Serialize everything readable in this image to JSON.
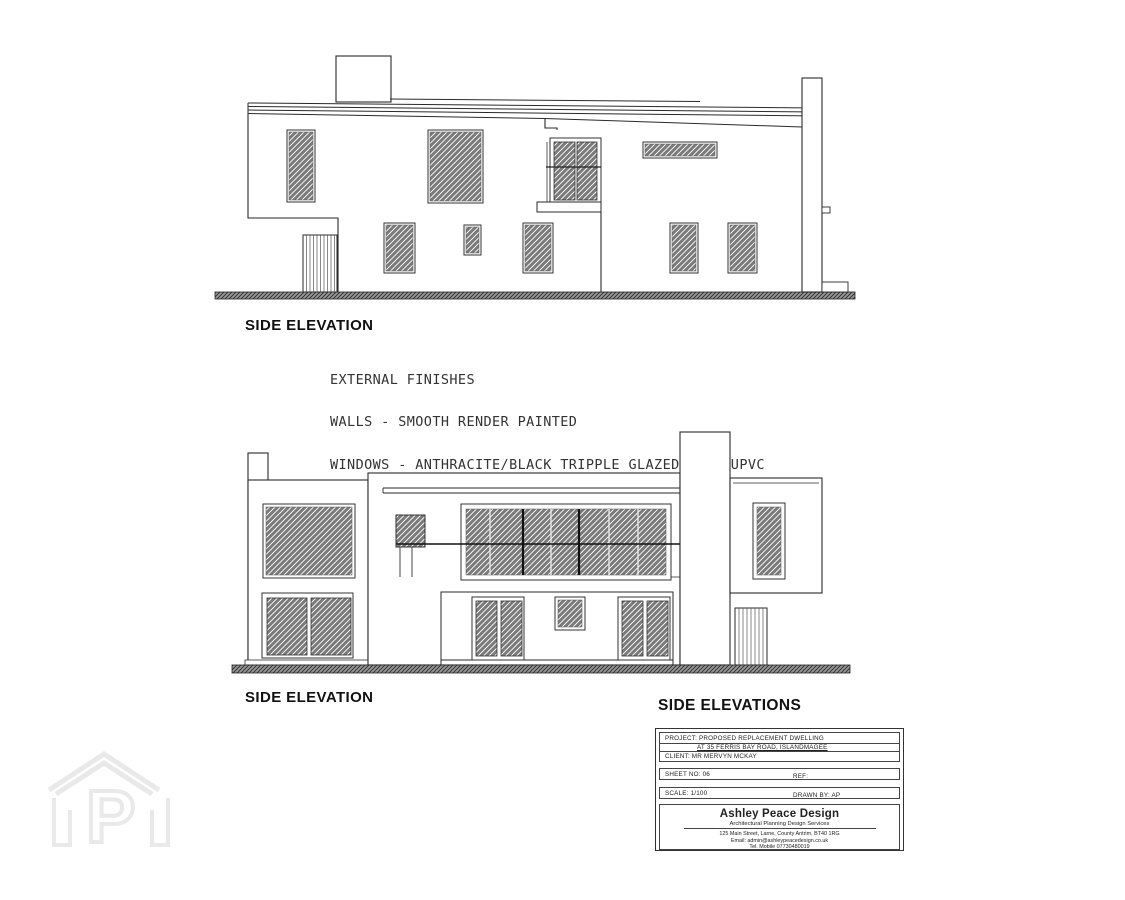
{
  "top_elevation": {
    "label": "SIDE ELEVATION"
  },
  "bottom_elevation": {
    "label": "SIDE ELEVATION"
  },
  "finishes": {
    "lines": [
      "EXTERNAL FINISHES",
      "WALLS - SMOOTH RENDER PAINTED",
      "WINDOWS - ANTHRACITE/BLACK TRIPPLE GLAZED ALUM/UPVC",
      "CILLS - ALUMINIUM/PVC TO MATCH WINDOWS",
      "ROOF - ZINC",
      "BALCONY - GLAZED SAFETY GLAZING"
    ]
  },
  "title_block": {
    "heading": "SIDE ELEVATIONS",
    "project_line": "PROJECT:  PROPOSED REPLACEMENT DWELLING",
    "address_line": "AT 35 FERRIS BAY ROAD, ISLANDMAGEE",
    "client_line": "CLIENT:   MR MERVYN MCKAY",
    "sheet_line": "SHEET NO: 06",
    "ref_line": "REF:",
    "scale_line": "SCALE: 1/100",
    "drawn_line": "DRAWN BY: AP",
    "company": {
      "name": "Ashley Peace Design",
      "tagline": "Architectural Planning Design Services",
      "address": "125 Main Street, Larne, County Antrim, BT40 1RG",
      "email": "Email: admin@ashleypeacedesign.co.uk",
      "tel": "Tel. Mobile 07730480019"
    }
  },
  "watermark": {
    "letter": "P"
  },
  "colors": {
    "line": "#2a2a2a",
    "window_fill": "#7a7a7a",
    "window_stripe": "#ffffff",
    "ground_fill": "#9a9a9a",
    "watermark": "#e9e9e9"
  }
}
